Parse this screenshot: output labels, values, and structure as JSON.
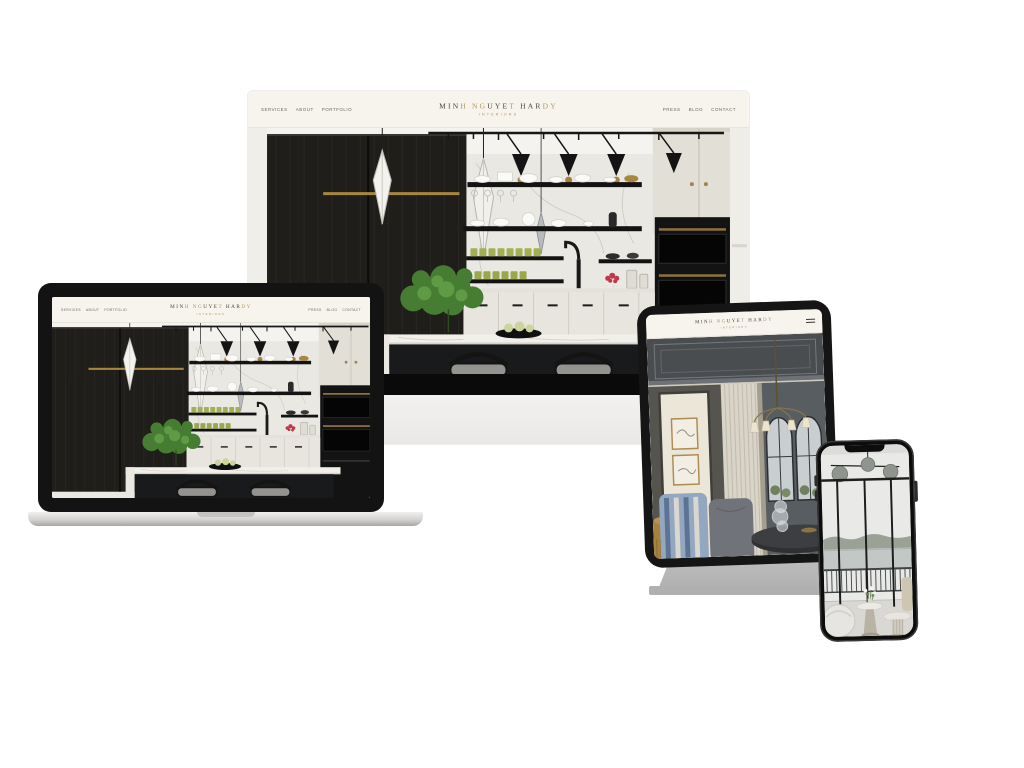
{
  "brand": {
    "logo_text": "MINH NGUYET HARDY",
    "logo_segments": [
      {
        "text": "MIN",
        "tone": "dark"
      },
      {
        "text": "H",
        "tone": "gold"
      },
      {
        "text": " ",
        "tone": "dark"
      },
      {
        "text": "NG",
        "tone": "gold"
      },
      {
        "text": "UYE",
        "tone": "dark"
      },
      {
        "text": "T",
        "tone": "gold"
      },
      {
        "text": " ",
        "tone": "dark"
      },
      {
        "text": "HAR",
        "tone": "dark"
      },
      {
        "text": "DY",
        "tone": "gold"
      }
    ],
    "tagline": "INTERIORS",
    "colors": {
      "logo_dark": "#4a443a",
      "logo_gold": "#b6945c",
      "header_background": "#f7f4ee"
    }
  },
  "navigation": {
    "left": [
      "SERVICES",
      "ABOUT",
      "PORTFOLIO"
    ],
    "right": [
      "PRESS",
      "BLOG",
      "CONTACT"
    ]
  },
  "devices": [
    {
      "id": "desktop",
      "label": "Desktop monitor",
      "screen_content": "Kitchen hero homepage"
    },
    {
      "id": "laptop",
      "label": "Laptop",
      "screen_content": "Kitchen hero homepage"
    },
    {
      "id": "tablet",
      "label": "Tablet",
      "screen_content": "Living room interior page",
      "icons": [
        "hamburger-menu-icon"
      ]
    },
    {
      "id": "phone",
      "label": "Phone",
      "screen_content": "Balcony interior photo"
    }
  ]
}
